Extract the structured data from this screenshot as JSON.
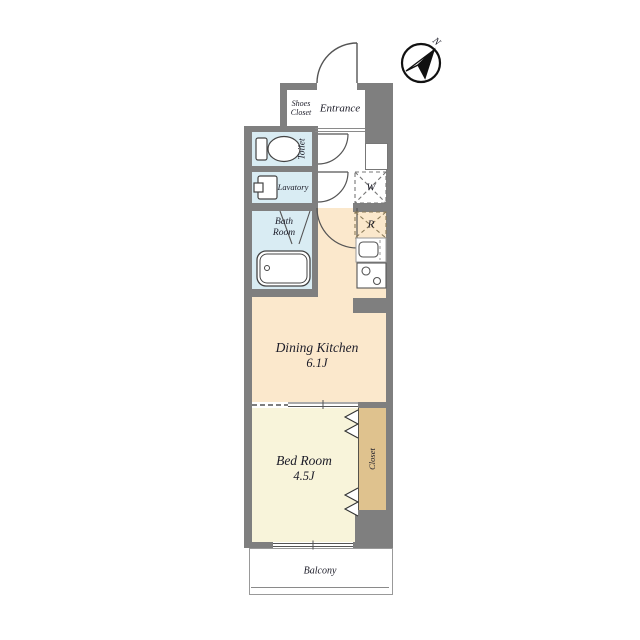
{
  "title": "1K apartment floor plan",
  "compass": {
    "north_label": "N"
  },
  "rooms": {
    "shoes_closet": {
      "line1": "Shoes",
      "line2": "Closet"
    },
    "entrance": {
      "label": "Entrance"
    },
    "toilet": {
      "label": "Toilet"
    },
    "lavatory": {
      "label": "Lavatory"
    },
    "bath": {
      "line1": "Bath",
      "line2": "Room"
    },
    "dining_kitchen": {
      "name": "Dining Kitchen",
      "size": "6.1J"
    },
    "bed_room": {
      "name": "Bed Room",
      "size": "4.5J"
    },
    "closet": {
      "label": "Closet"
    },
    "balcony": {
      "label": "Balcony"
    },
    "washer_place": {
      "label": "W"
    },
    "refrigerator_place": {
      "label": "R"
    }
  },
  "colors": {
    "wall": "#7f7f7f",
    "wet_area_floor": "#d9ecf3",
    "dining_kitchen_floor": "#fbe8cc",
    "bed_room_floor": "#f8f4da",
    "closet_floor": "#dfc28e",
    "balcony_floor": "#ffffff",
    "line": "#555555"
  }
}
